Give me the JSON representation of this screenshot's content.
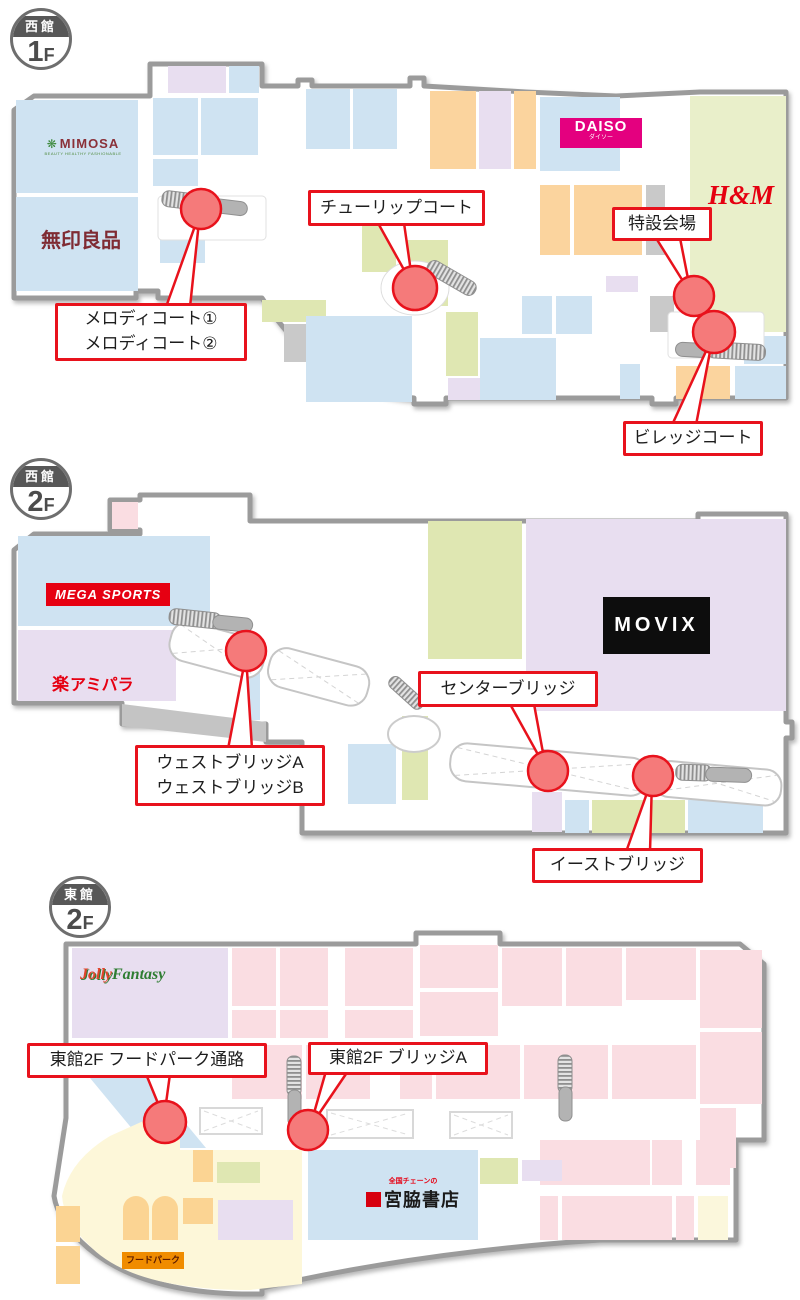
{
  "floors": [
    {
      "id": "west-1f",
      "badge": {
        "building": "西館",
        "level": "1",
        "level_suffix": "F"
      },
      "stores": {
        "mimosa": {
          "name": "MIMOSA",
          "tagline": "BEAUTY HEALTHY FASHIONABLE"
        },
        "muji": {
          "name": "無印良品"
        },
        "daiso": {
          "name": "DAISO",
          "reading": "ダイソー"
        },
        "hm": {
          "name": "H&M"
        }
      },
      "callouts": {
        "tulip": {
          "label": "チューリップコート"
        },
        "special": {
          "label": "特設会場"
        },
        "melody": {
          "line1": "メロディコート①",
          "line2": "メロディコート②"
        },
        "village": {
          "label": "ビレッジコート"
        }
      }
    },
    {
      "id": "west-2f",
      "badge": {
        "building": "西館",
        "level": "2",
        "level_suffix": "F"
      },
      "stores": {
        "mega_sports": {
          "name": "MEGA SPORTS"
        },
        "amipara": {
          "prefix": "楽",
          "name": "アミパラ"
        },
        "movix": {
          "name": "MOVIX"
        }
      },
      "callouts": {
        "center": {
          "label": "センターブリッジ"
        },
        "west": {
          "line1": "ウェストブリッジA",
          "line2": "ウェストブリッジB"
        },
        "east": {
          "label": "イーストブリッジ"
        }
      }
    },
    {
      "id": "east-2f",
      "badge": {
        "building": "東館",
        "level": "2",
        "level_suffix": "F"
      },
      "stores": {
        "jollyfantasy": {
          "name_first": "Jolly",
          "name_rest": "Fantasy"
        },
        "miyawaki": {
          "tagline": "全国チェーンの",
          "name": "宮脇書店"
        },
        "foodpark": {
          "name": "フードパーク"
        }
      },
      "callouts": {
        "foodpark_path": {
          "label": "東館2F フードパーク通路"
        },
        "bridge_a": {
          "label": "東館2F ブリッジA"
        }
      }
    }
  ],
  "colors": {
    "accent_red": "#e8121c",
    "marker_fill": "#f57a7a",
    "daiso_pink": "#e4007f",
    "mega_red": "#e60012",
    "movix_black": "#0d0d0d",
    "hm_red": "#e50010",
    "muji_maroon": "#7f2b33",
    "foodpark_orange": "#f08c00"
  }
}
